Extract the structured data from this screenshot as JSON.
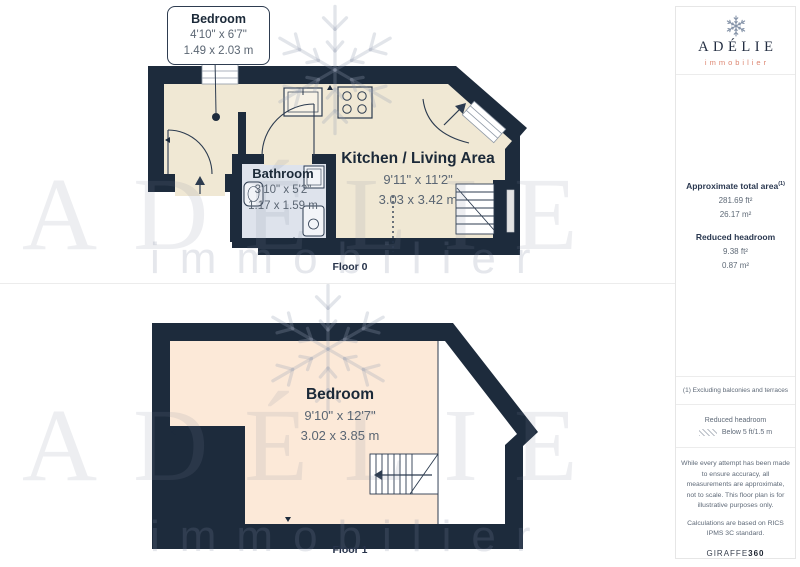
{
  "floor0": {
    "caption": "Floor 0",
    "callout": {
      "room": "Bedroom",
      "imperial": "4'10\" x 6'7\"",
      "metric": "1.49 x 2.03 m"
    },
    "kitchen": {
      "name": "Kitchen / Living Area",
      "imperial": "9'11\" x 11'2\"",
      "metric": "3.03 x 3.42 m"
    },
    "bathroom": {
      "name": "Bathroom",
      "imperial": "3'10\" x 5'2\"",
      "metric": "1.17 x 1.59 m"
    }
  },
  "floor1": {
    "caption": "Floor 1",
    "bedroom": {
      "name": "Bedroom",
      "imperial": "9'10\" x 12'7\"",
      "metric": "3.02 x 3.85 m"
    }
  },
  "watermark": {
    "brand": "ADÉLIE",
    "tagline": "immobilier"
  },
  "sidebar": {
    "brand": "ADÉLIE",
    "tagline": "immobilier",
    "total_area_label": "Approximate total area",
    "total_area_sup": "(1)",
    "total_area_ft": "281.69 ft²",
    "total_area_m": "26.17 m²",
    "headroom_label": "Reduced headroom",
    "headroom_ft": "9.38 ft²",
    "headroom_m": "0.87 m²",
    "footnote": "(1) Excluding balconies and terraces",
    "legend_title": "Reduced headroom",
    "legend_item": "Below 5 ft/1.5 m",
    "disclaimer_1": "While every attempt has been made to ensure accuracy, all measurements are approximate, not to scale. This floor plan is for illustrative purposes only.",
    "disclaimer_2": "Calculations are based on RICS IPMS 3C standard.",
    "credit_name": "GIRAFFE",
    "credit_number": "360"
  },
  "colors": {
    "wall": "#1d2b3c",
    "floor0": "#f0e8d4",
    "floor1": "#fce9d8",
    "bathroom_floor": "#dee3ec",
    "accent_salmon": "#dd8671",
    "dim_text": "#5b6673"
  }
}
